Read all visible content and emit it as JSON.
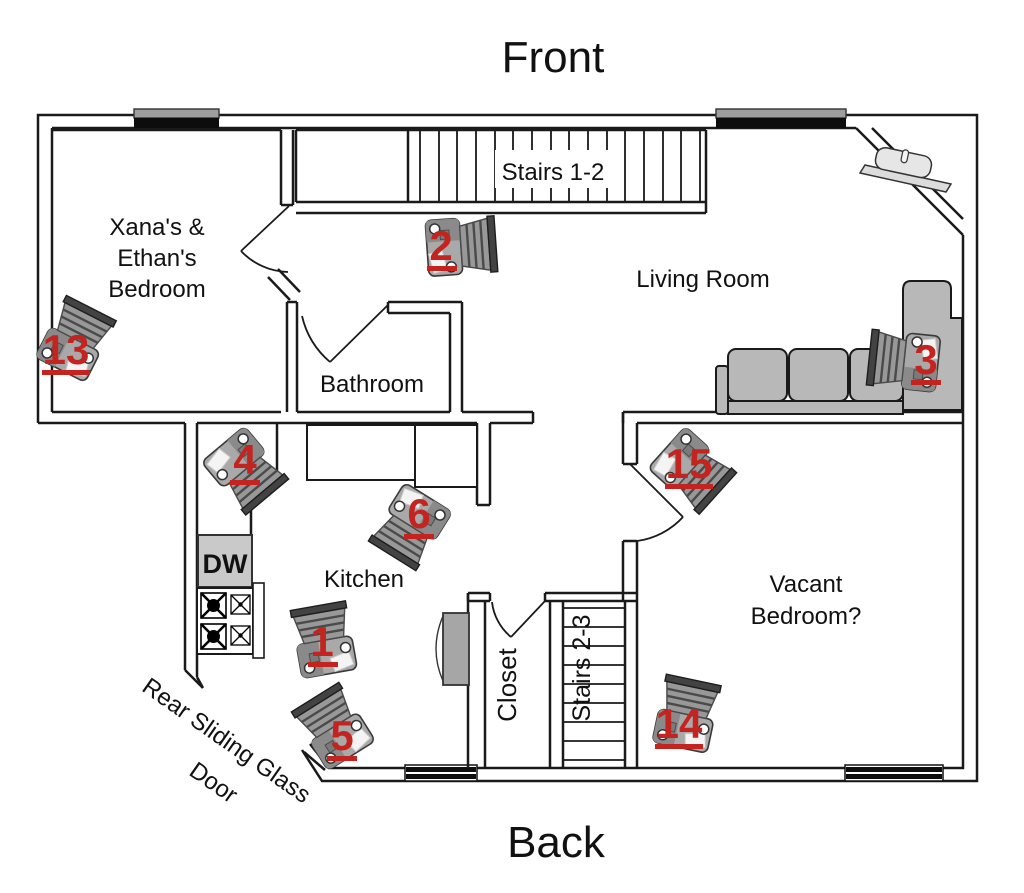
{
  "orientation": {
    "front": "Front",
    "back": "Back"
  },
  "rooms": {
    "bedroom_line1": "Xana's &",
    "bedroom_line2": "Ethan's",
    "bedroom_line3": "Bedroom",
    "living_room": "Living Room",
    "bathroom": "Bathroom",
    "kitchen": "Kitchen",
    "closet": "Closet",
    "vacant_line1": "Vacant",
    "vacant_line2": "Bedroom?"
  },
  "stairs": {
    "upper": "Stairs 1-2",
    "lower": "Stairs 2-3"
  },
  "appliances": {
    "dishwasher": "DW"
  },
  "doors": {
    "rear_line1": "Rear Sliding Glass",
    "rear_line2": "Door"
  },
  "cameras": [
    {
      "number": "1"
    },
    {
      "number": "2"
    },
    {
      "number": "3"
    },
    {
      "number": "4"
    },
    {
      "number": "5"
    },
    {
      "number": "6"
    },
    {
      "number": "13"
    },
    {
      "number": "14"
    },
    {
      "number": "15"
    }
  ],
  "colors": {
    "camera_number": "#c42420",
    "wall": "#1a1a1a",
    "furniture": "#b8b8b8"
  },
  "icons": {
    "camera": "security-camera-icon",
    "fireplace": "corner-fireplace-icon",
    "stove": "stove-burners-icon",
    "window": "window-bar-icon"
  }
}
